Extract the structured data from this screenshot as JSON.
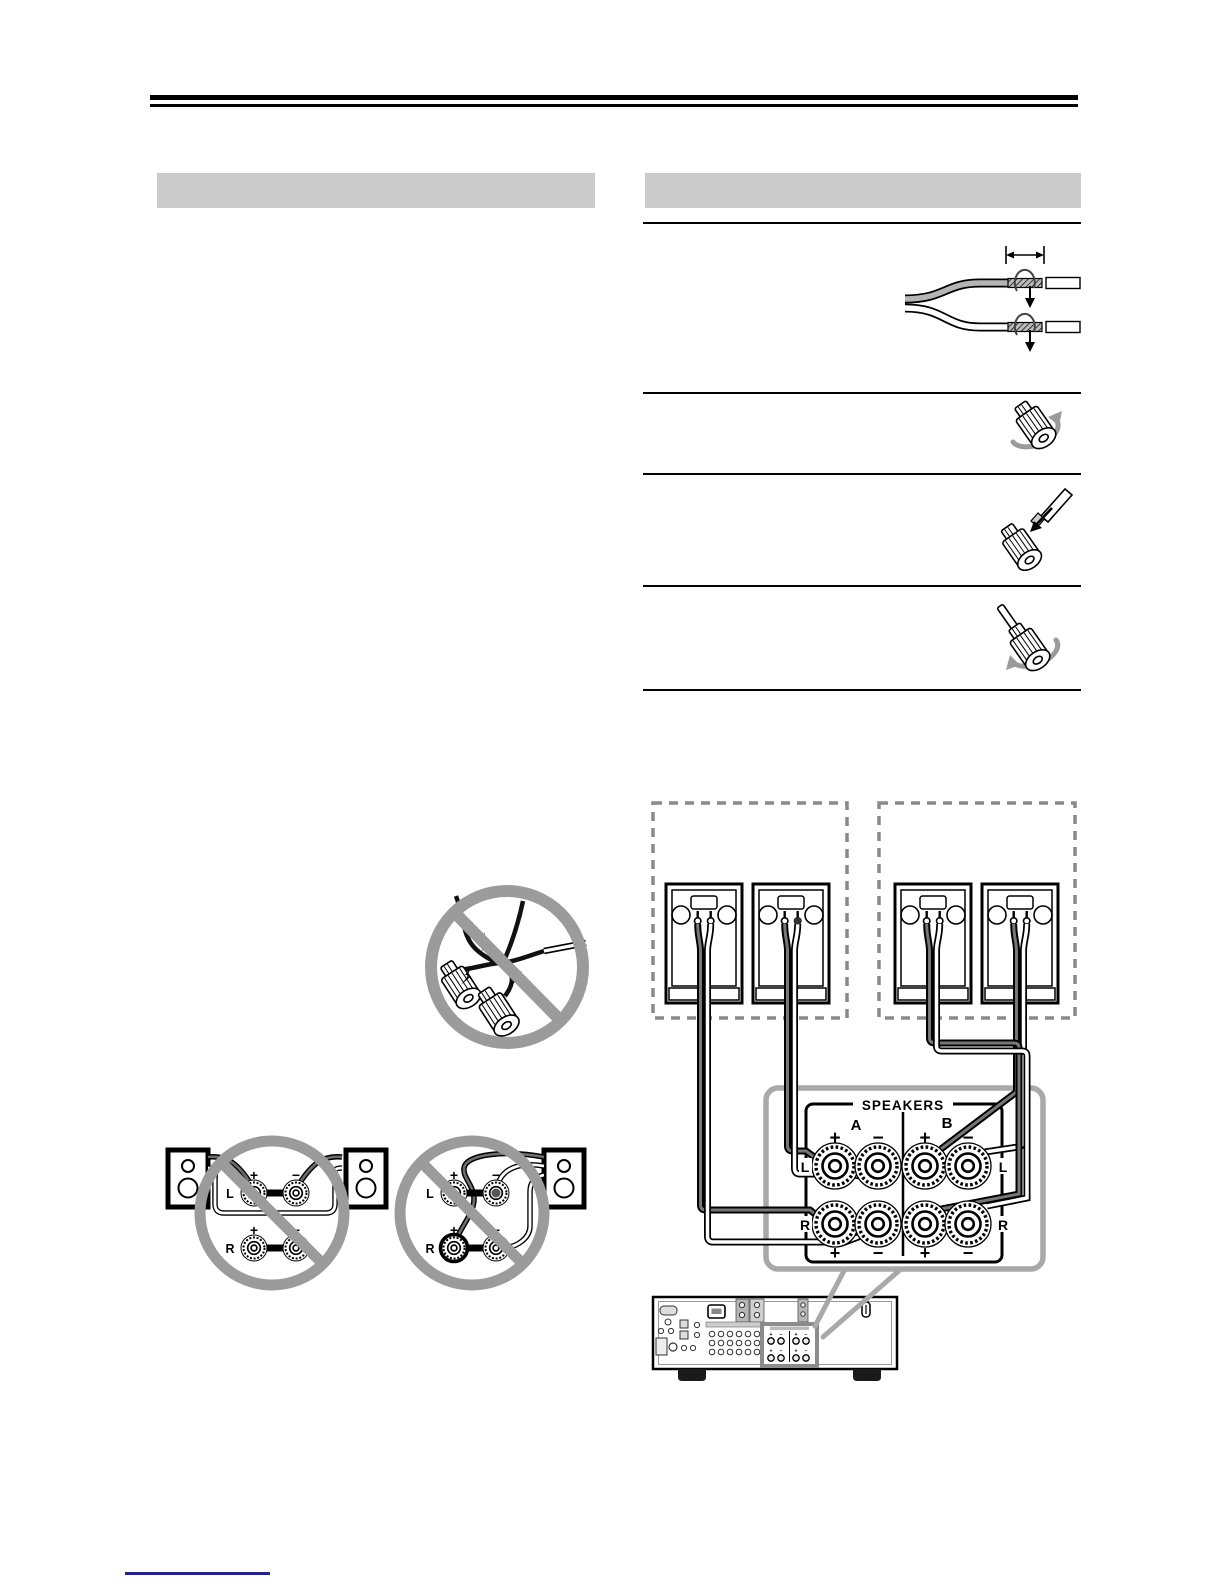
{
  "page": {
    "width": 1224,
    "height": 1584,
    "background": "#ffffff"
  },
  "colors": {
    "section_bar": "#cbcbcb",
    "top_rule": "#000000",
    "footer_rule": "#22228f",
    "prohibit_gray": "#9b9b9b",
    "callout_gray": "#a9a9a9",
    "receiver_highlight": "#8c8c8c",
    "wire_dark": "#777777",
    "wire_white": "#ffffff"
  },
  "sections": {
    "left_header_label": "",
    "right_header_label": ""
  },
  "instructions": {
    "step_icons": [
      "strip-and-twist-wire-icon",
      "loosen-terminal-knob-icon",
      "insert-wire-into-terminal-icon",
      "tighten-terminal-knob-icon"
    ]
  },
  "wiring": {
    "speakers_label": "SPEAKERS",
    "group_a": "A",
    "group_b": "B",
    "plus": "+",
    "minus": "−",
    "left": "L",
    "right": "R"
  },
  "prohibited": {
    "plus": "+",
    "minus": "−",
    "left": "L",
    "right": "R"
  }
}
